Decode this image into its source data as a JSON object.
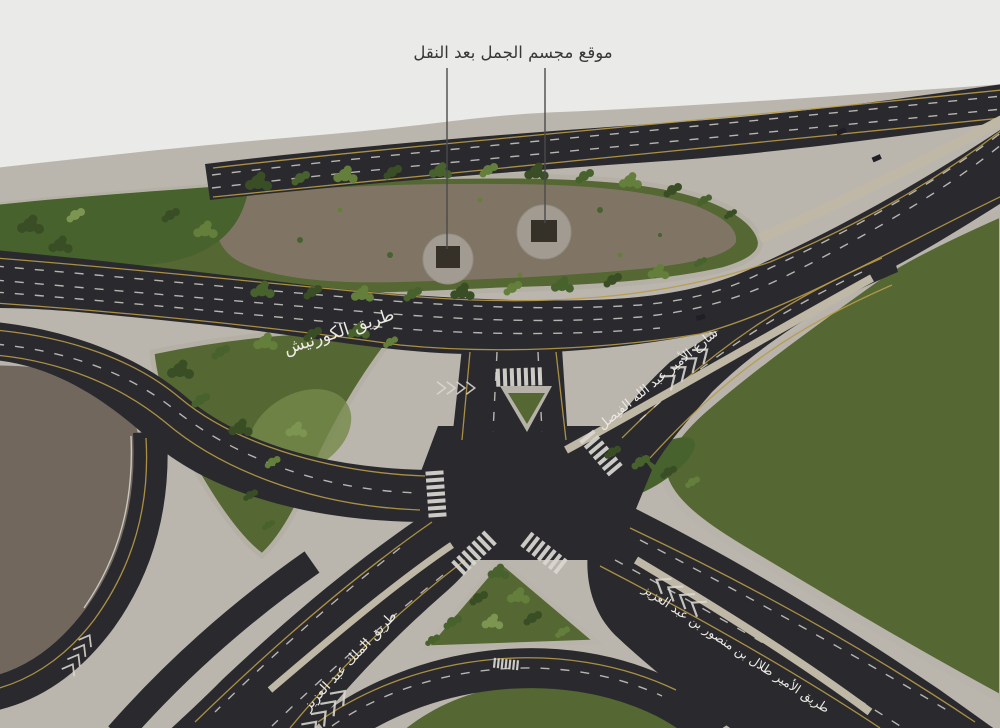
{
  "annotation": {
    "label": "موقع مجسم الجمل بعد النقل",
    "marker_count": 2
  },
  "road_labels": {
    "corniche": "طريق الكورنيش",
    "abdullah_al_faisal": "شارع الأمير عبد الله الفيصل",
    "king_abdulaziz": "طريق الملك عبد العزيز",
    "talal_bin_mansour": "طريق الأمير طلال بن منصور بن عبد العزيز"
  },
  "colors": {
    "page_bg": "#fdfdfb",
    "pavement": "#cbc5bb",
    "sidewalk": "#c8c3b9",
    "road": "#2e2e32",
    "dirt_lot": "#7b7065",
    "island_dirt": "#8b7f6e",
    "grass": "#5c7037",
    "grass_light": "#7f9551",
    "tree_dark": "#3f5529",
    "tree_mid": "#4e6a31",
    "tree_light": "#6d8a40",
    "tree_pale": "#87a258",
    "plaza": "#b0a89d",
    "statue": "#3a362d",
    "median_tan": "#cfc7b4",
    "lane_white": "#eceae3",
    "lane_yellow": "#c7a84e",
    "leader_line": "#4a4a4a",
    "annotation_text": "#383838"
  }
}
